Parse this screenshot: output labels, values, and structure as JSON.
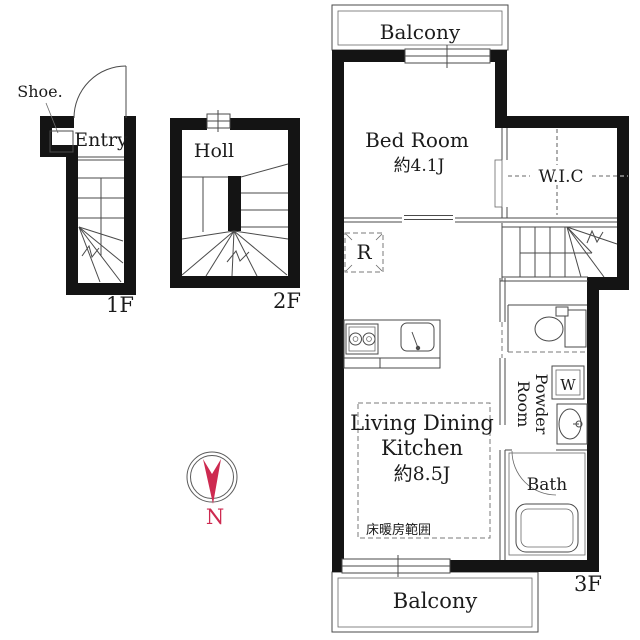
{
  "colors": {
    "wall": "#141414",
    "line": "#4a4a4a",
    "accent": "#cd2a50"
  },
  "floor1": {
    "label": "1F",
    "entry": "Entry",
    "shoe": "Shoe."
  },
  "floor2": {
    "label": "2F",
    "hall": "Holl"
  },
  "floor3": {
    "label": "3F",
    "balcony_top": "Balcony",
    "balcony_bottom": "Balcony",
    "bedroom_name": "Bed Room",
    "bedroom_size": "約4.1J",
    "wic": "W.I.C",
    "refrigerator": "R",
    "ldk_line1": "Living Dining",
    "ldk_line2": "Kitchen",
    "ldk_size": "約8.5J",
    "floor_heating": "床暖房範囲",
    "powder_line1": "Powder",
    "powder_line2": "Room",
    "washer": "W",
    "bath": "Bath"
  },
  "compass": {
    "north": "N"
  }
}
